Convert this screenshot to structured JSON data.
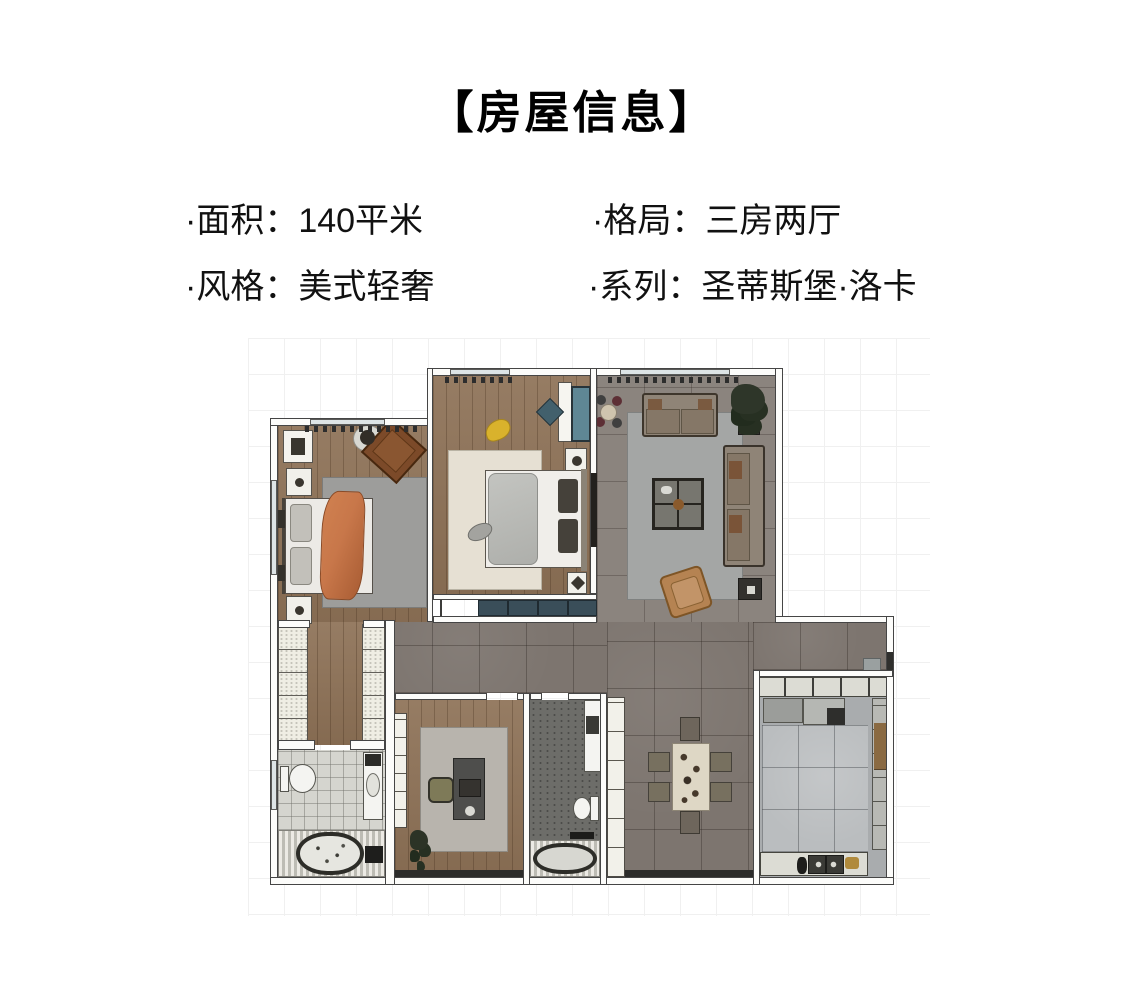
{
  "header": {
    "title": "【房屋信息】"
  },
  "details": {
    "items": [
      {
        "id": "area",
        "label": "面积",
        "value": "140平米",
        "text": "·面积：140平米"
      },
      {
        "id": "layout",
        "label": "格局",
        "value": "三房两厅",
        "text": "·格局：三房两厅"
      },
      {
        "id": "style",
        "label": "风格",
        "value": "美式轻奢",
        "text": "·风格：美式轻奢"
      },
      {
        "id": "series",
        "label": "系列",
        "value": "圣蒂斯堡·洛卡",
        "text": "·系列：圣蒂斯堡·洛卡"
      }
    ]
  },
  "floorplan": {
    "type": "apartment-floor-plan",
    "rooms": [
      "bedroom-2",
      "master-bedroom",
      "living-room",
      "walk-in-closet",
      "bathroom-1",
      "study",
      "bathroom-2",
      "dining-area",
      "hallway",
      "kitchen"
    ],
    "colors": {
      "wood_floor": "#8d7156",
      "hall_tile": "#7d756f",
      "living_tile": "#8b847e",
      "kitchen_marble": "#babdbf",
      "bath_tile_light": "#d5d5cf",
      "bath_tile_dark": "#6d6d69",
      "accent_orange": "#c8774a",
      "accent_teal": "#3a4e59",
      "wall_fill": "#fcfcfa",
      "wall_outline": "#454545",
      "background_grid": "#f0f0f0"
    }
  }
}
